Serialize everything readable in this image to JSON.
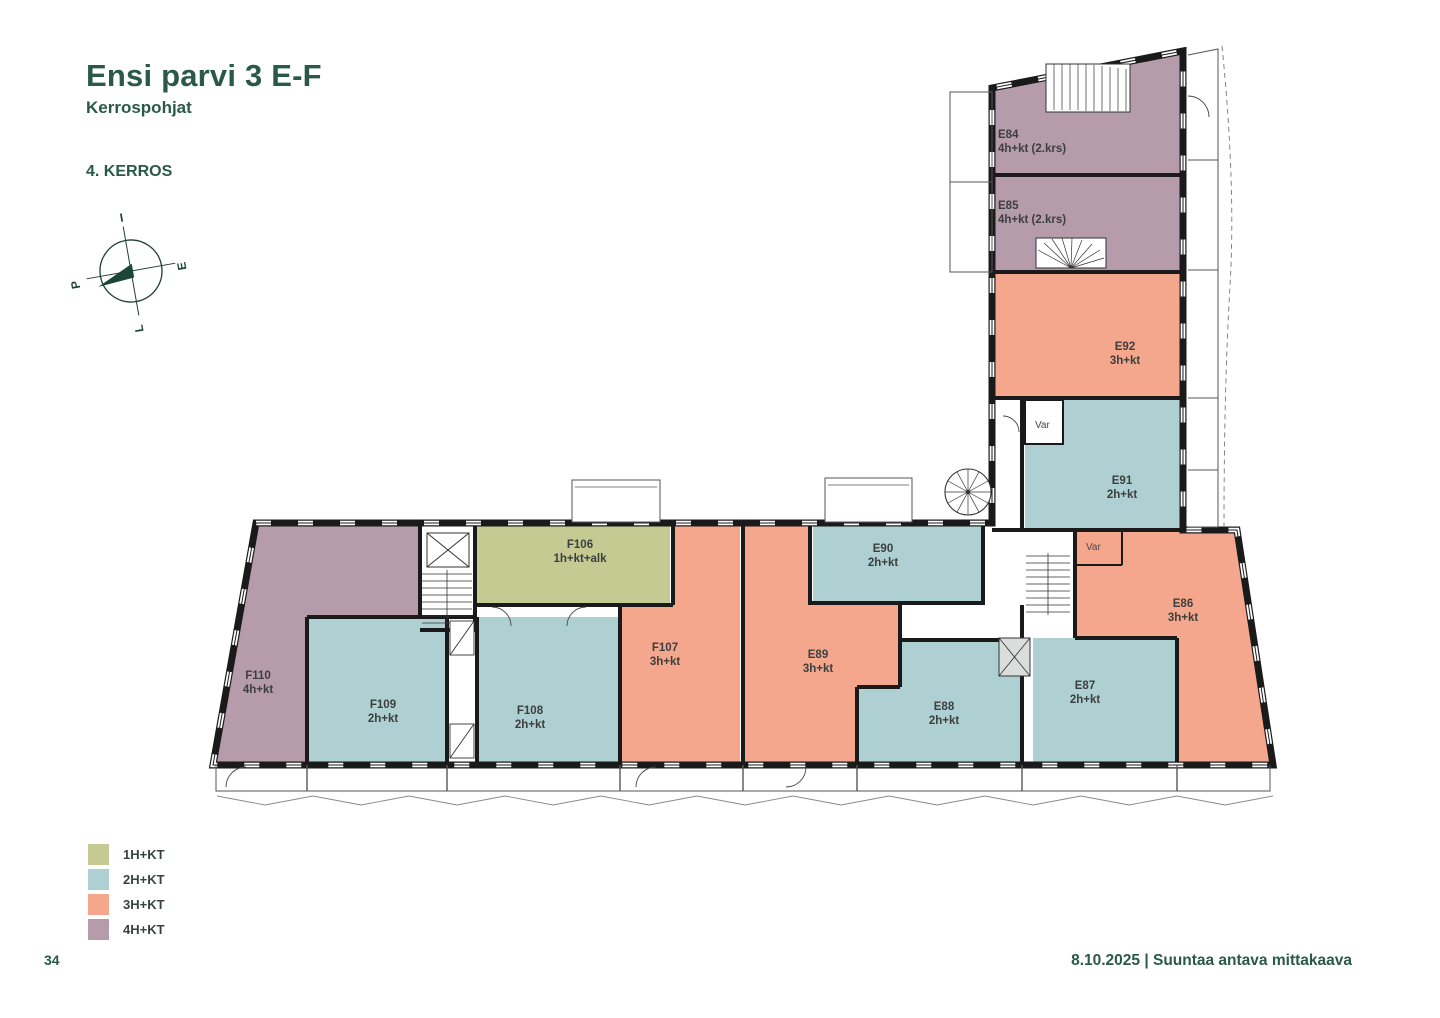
{
  "meta": {
    "title": "Ensi parvi 3 E-F",
    "subtitle": "Kerrospohjat",
    "floor_label": "4. KERROS",
    "page_number": "34",
    "footer_note": "8.10.2025 | Suuntaa antava mittakaava"
  },
  "compass": {
    "top": "I",
    "right": "E",
    "bottom": "L",
    "left": "P"
  },
  "colors": {
    "1H+KT": "#c5ca92",
    "2H+KT": "#afd0d3",
    "3H+KT": "#f5a78d",
    "4H+KT": "#b69cab"
  },
  "legend": {
    "items": [
      {
        "label": "1H+KT"
      },
      {
        "label": "2H+KT"
      },
      {
        "label": "3H+KT"
      },
      {
        "label": "4H+KT"
      }
    ]
  },
  "plan": {
    "storage_label": "Var",
    "apartments": {
      "E84": {
        "id": "E84",
        "type": "4h+kt (2.krs)"
      },
      "E85": {
        "id": "E85",
        "type": "4h+kt (2.krs)"
      },
      "E92": {
        "id": "E92",
        "type": "3h+kt"
      },
      "E91": {
        "id": "E91",
        "type": "2h+kt"
      },
      "E90": {
        "id": "E90",
        "type": "2h+kt"
      },
      "E89": {
        "id": "E89",
        "type": "3h+kt"
      },
      "E88": {
        "id": "E88",
        "type": "2h+kt"
      },
      "E87": {
        "id": "E87",
        "type": "2h+kt"
      },
      "E86": {
        "id": "E86",
        "type": "3h+kt"
      },
      "F106": {
        "id": "F106",
        "type": "1h+kt+alk"
      },
      "F107": {
        "id": "F107",
        "type": "3h+kt"
      },
      "F108": {
        "id": "F108",
        "type": "2h+kt"
      },
      "F109": {
        "id": "F109",
        "type": "2h+kt"
      },
      "F110": {
        "id": "F110",
        "type": "4h+kt"
      }
    }
  }
}
